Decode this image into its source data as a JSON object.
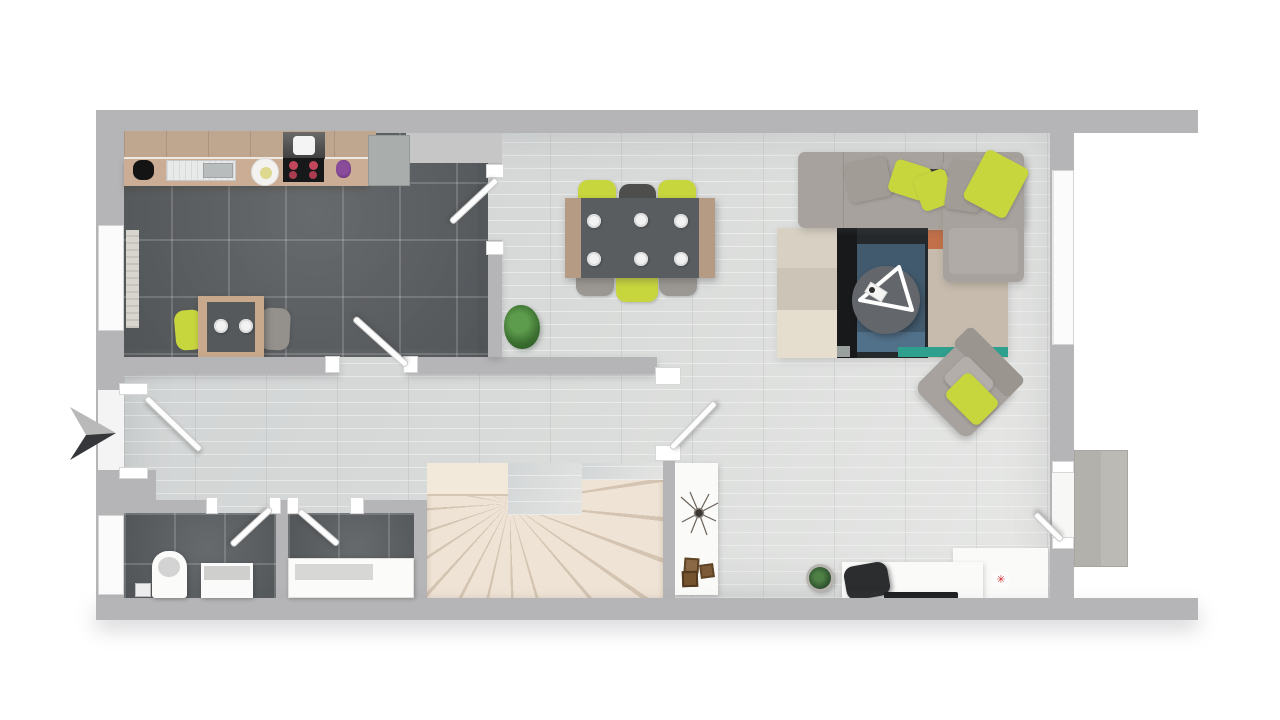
{
  "scene": {
    "type": "floor-plan",
    "style": "top-down 3d architectural render",
    "labels_visible": false,
    "entry_side": "left"
  },
  "palette": {
    "background": "#ffffff",
    "wall": "#b5b5b7",
    "dark_tile_floor": "#5b5f62",
    "light_wood_floor": "#d8dad9",
    "stairs_cream": "#eee3d5",
    "accent_lime": "#c8d63e",
    "sofa_gray": "#a7a29d",
    "counter_wood": "#c4a88e",
    "table_top_dark": "#5a5d60",
    "rug_navy": "#26292c",
    "rug_blue": "#415a6d",
    "rug_beige": "#d7d0c3",
    "rug_teal": "#2f9f8e",
    "rug_orange": "#c27049",
    "door_white": "#fdfdfd",
    "concrete_pad": "#b8b6b1",
    "burner_red": "#c2475a",
    "plant_green": "#3c7031"
  },
  "rooms": [
    {
      "name": "kitchen",
      "floor": "dark tile",
      "features": [
        "counter with sink",
        "cooktop with hood",
        "refrigerator",
        "small table with 2 chairs",
        "window"
      ]
    },
    {
      "name": "dining-area",
      "floor": "light wood",
      "features": [
        "table with 6 place settings",
        "6 chairs",
        "potted plant"
      ]
    },
    {
      "name": "living-room",
      "floor": "light wood",
      "features": [
        "corner sofa with chaise",
        "patchwork rug",
        "round coffee table",
        "rotated armchair",
        "desk with office chair",
        "tall window",
        "terrace door"
      ]
    },
    {
      "name": "hallway",
      "floor": "light wood",
      "features": [
        "entrance door",
        "entry direction arrow"
      ]
    },
    {
      "name": "wc",
      "floor": "dark tile",
      "features": [
        "toilet",
        "vanity",
        "window"
      ]
    },
    {
      "name": "bathroom",
      "floor": "dark tile",
      "features": [
        "bathtub"
      ]
    },
    {
      "name": "staircase",
      "floor": "cream winder stairs",
      "features": [
        "console table with decor boxes"
      ]
    }
  ],
  "furniture_counts": {
    "dining_plates": 6,
    "dining_chairs": 6,
    "kitchen_chairs": 2,
    "sofa_pillows": 5,
    "decor_boxes": 3,
    "doors": 7,
    "windows": 3
  },
  "icons": {
    "entrance_arrow": "entry-direction-arrow",
    "desk_gadget_glyph": "✳"
  }
}
